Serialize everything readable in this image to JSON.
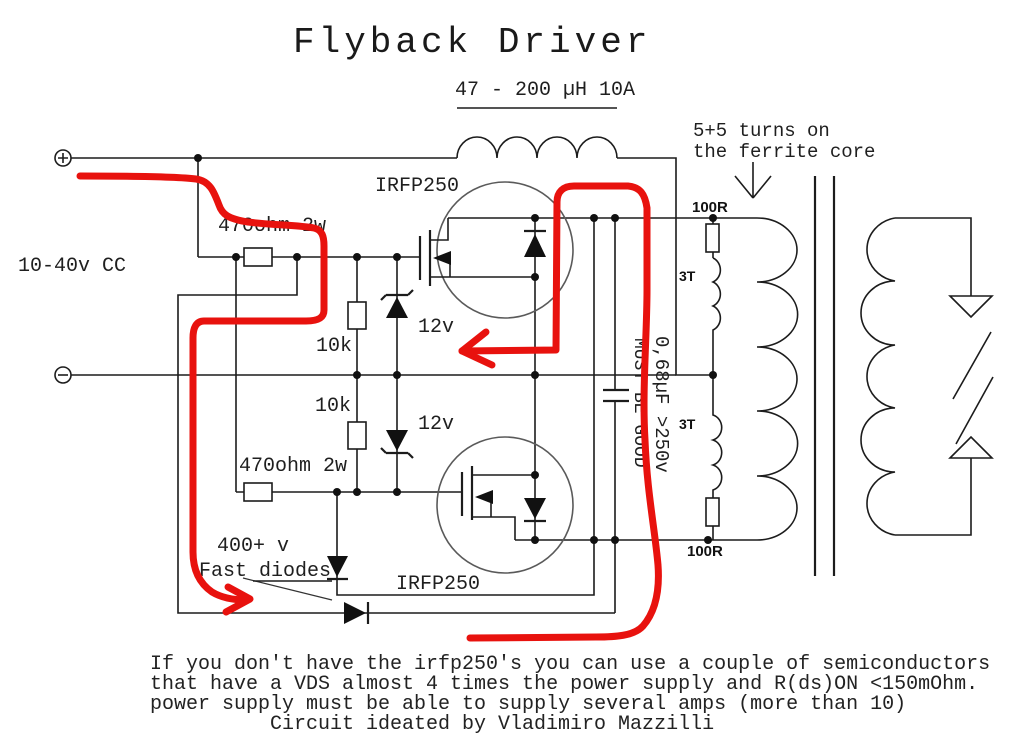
{
  "title": "Flyback Driver",
  "labels": {
    "choke": "47 - 200 µH 10A",
    "turns_note_line1": "5+5 turns on",
    "turns_note_line2": "the ferrite core",
    "supply": "10-40v CC",
    "mosfet_top": "IRFP250",
    "mosfet_bottom": "IRFP250",
    "gate_resistor_top": "470ohm 2w",
    "gate_resistor_bottom": "470ohm 2w",
    "pulldown_top": "10k",
    "pulldown_bottom": "10k",
    "zener_top": "12v",
    "zener_bottom": "12v",
    "damp_resistor_top": "100R",
    "damp_resistor_bottom": "100R",
    "coil_top": "3T",
    "coil_bottom": "3T",
    "cap_value": "0,68µF >250v",
    "cap_note": "MUST BE GOOD",
    "diode_note_line1": "400+ v",
    "diode_note_line2": "Fast diodes",
    "terminal_plus": "+",
    "terminal_minus": "-"
  },
  "footer": {
    "line1": "If you don't have the irfp250's you can use a couple of semiconductors",
    "line2": "that have a VDS almost 4 times the power supply and R(ds)ON <150mOhm.",
    "line3": "power supply must be able to supply several amps (more than 10)",
    "line4": "Circuit ideated by Vladimiro Mazzilli"
  },
  "colors": {
    "ink": "#1c1c1c",
    "annotation_red": "#e8120e",
    "background": "#ffffff"
  }
}
